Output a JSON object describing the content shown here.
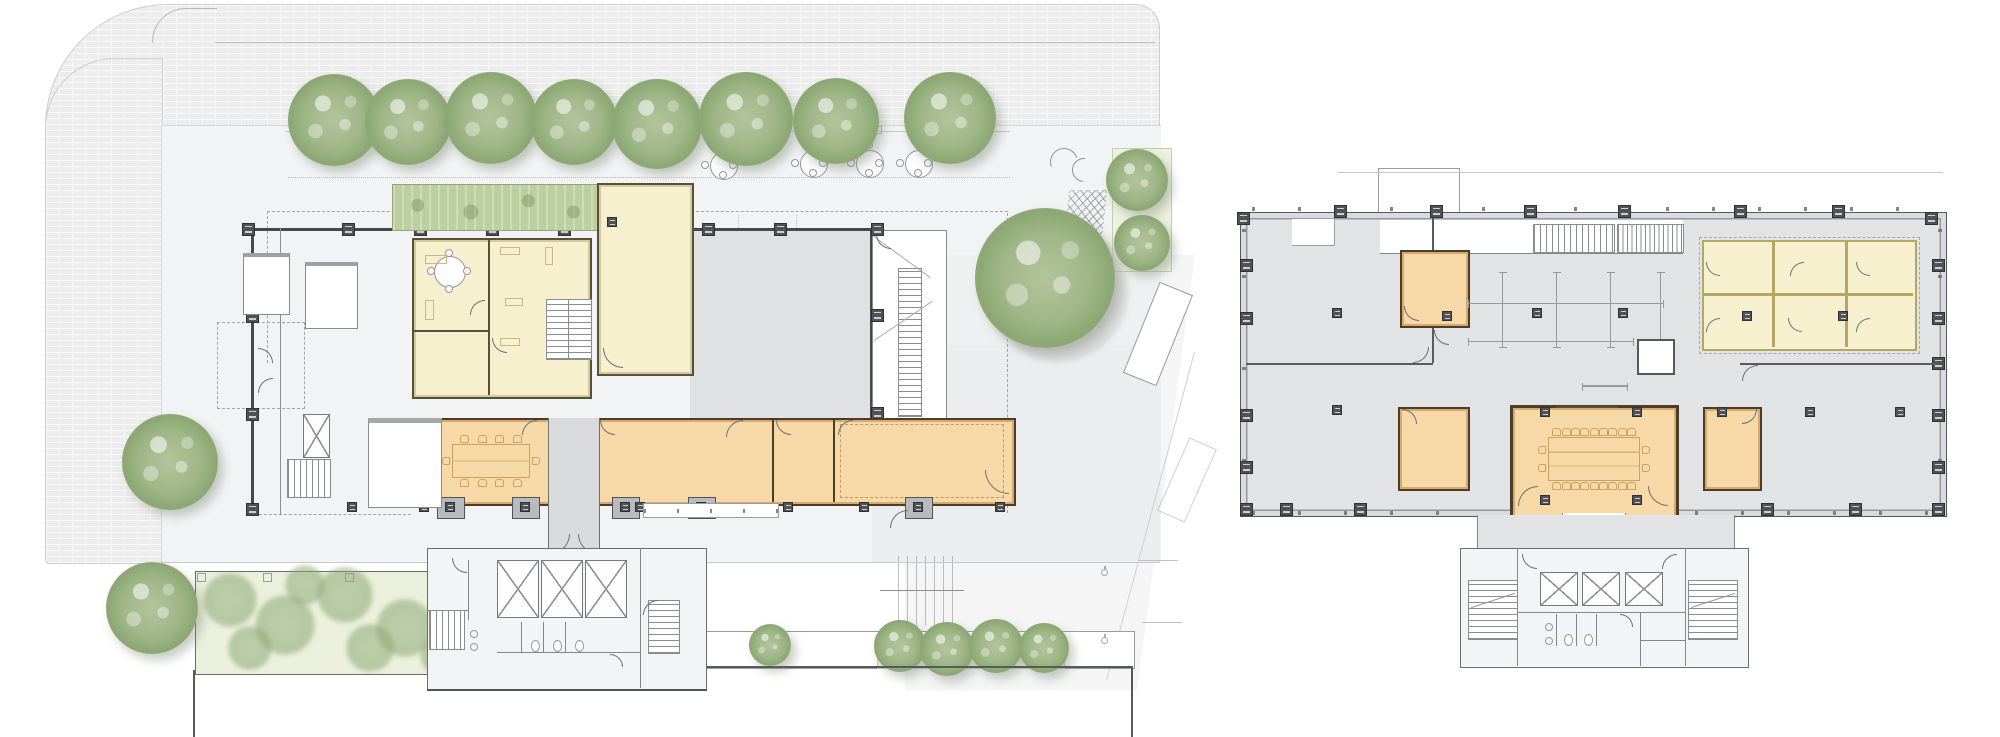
{
  "page": {
    "title": "",
    "background": "#ffffff",
    "visible_text": []
  },
  "drawing": {
    "kind": "architectural floor plan pair",
    "plans": [
      {
        "id": "left-plan",
        "name": "ground floor site plan",
        "site_features": [
          "brick paved sidewalk with rounded corner",
          "plaza",
          "row of 8 street trees with benches",
          "4 round cafe tables with 4 chairs each",
          "play structures and climbing net",
          "large courtyard tree",
          "planted green bed with shrubs",
          "street planter with small tree and 4-bush hedge row",
          "access ramp",
          "accessible parking stalls with 2 wheelchair symbols",
          "dashed canopy outlines",
          "site boundary lines"
        ],
        "building_features": [
          "yellow office rooms with desks, stair and round 4-seat meeting table",
          "green hedge roof strip",
          "double-height yellow hall",
          "open gray hall on column grid",
          "orange meeting room band with 10-seat conference table",
          "central corridor with double doors",
          "white rooms",
          "elevator-and-stair core",
          "service core with 3 elevators, toilets and 2 stairs",
          "exterior switchback stair",
          "steel I-columns along colonnade"
        ]
      },
      {
        "id": "right-plan",
        "name": "upper floor plan",
        "features": [
          "rectangular gray floor plate with perimeter I-columns and window mullions",
          "roof terrace line and stair bulkhead",
          "yellow six-cell room grid with doors (2 rows x 3 columns)",
          "3 small orange rooms",
          "central orange conference room with 22-seat table and entry vestibule",
          "two straight stair runs",
          "movable partition track symbols",
          "small white shaft box",
          "service core with 3 elevators, 2 stairs and toilets"
        ]
      }
    ],
    "counts": {
      "street_trees": 8,
      "cafe_tables": 4,
      "chairs_small_conference": 10,
      "chairs_large_conference": 22,
      "elevators_left_core": 3,
      "elevators_right_core": 3,
      "yellow_grid_cells": 6,
      "wheelchair_symbols": 2
    }
  },
  "colors": {
    "paver": "#ececed",
    "plaza": "#f2f3f4",
    "courtyard": "#ebecee",
    "floor_gray": "#e2e3e5",
    "room_gray": "#e0e1e3",
    "corridor_gray": "#d9dadb",
    "room_yellow": "#f6f0ce",
    "room_orange": "#f7d9a8",
    "wall_dark": "#47484b",
    "wall_olive": "#57513a",
    "wall_tan": "#c9a268",
    "hedge_green": "#bccf9f",
    "tree_green": "#9fb687",
    "bed_green": "#eaf0db",
    "column_dark": "#515256",
    "line_gray": "#9b9c9e"
  }
}
